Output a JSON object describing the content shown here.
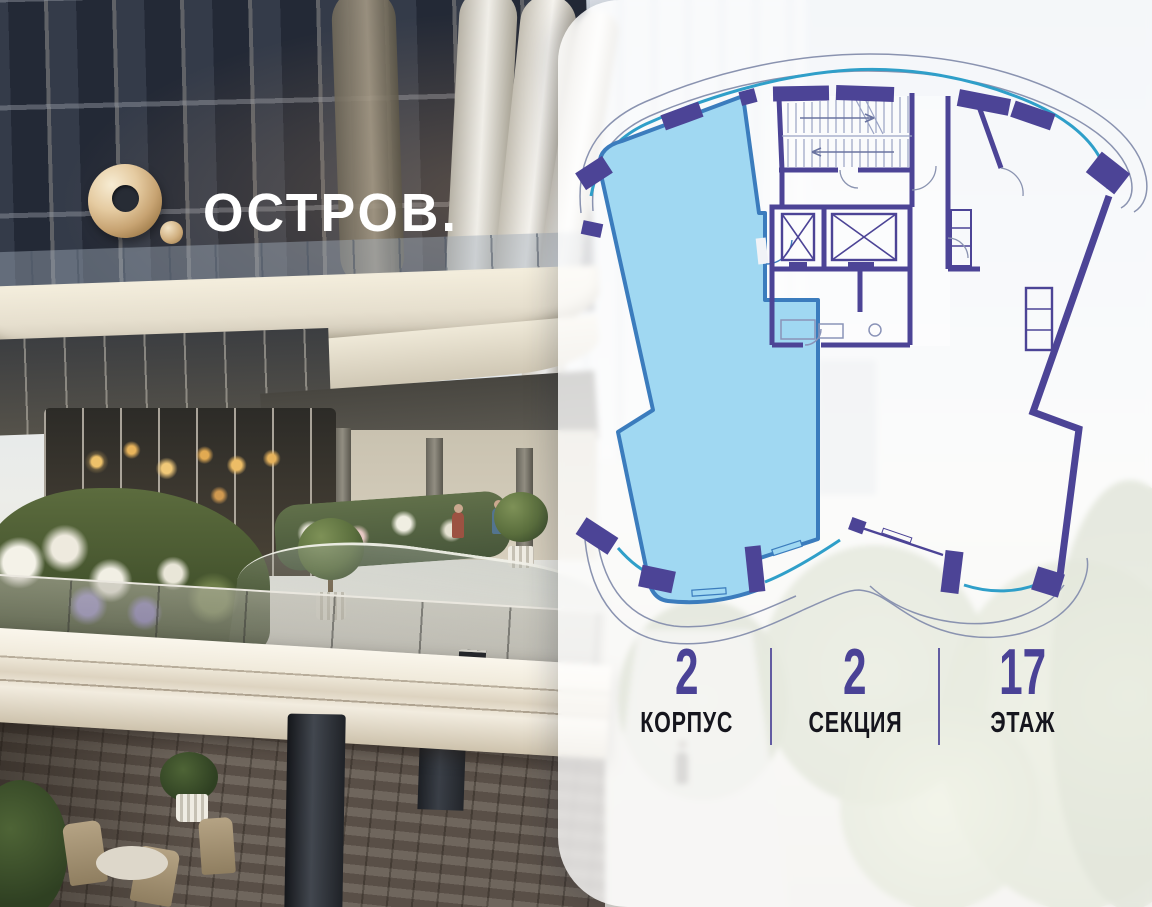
{
  "brand": {
    "logo_text": "ОСТРОВ."
  },
  "panel": {
    "stats": [
      {
        "value": "2",
        "label": "КОРПУС"
      },
      {
        "value": "2",
        "label": "СЕКЦИЯ"
      },
      {
        "value": "17",
        "label": "ЭТАЖ"
      }
    ],
    "accent_color": "#4a4296",
    "background": "rgba(255,255,255,0.78)"
  },
  "floorplan": {
    "highlighted_unit": {
      "fill": "#a0d8f2",
      "outline": "#3b7cbd",
      "state": "highlighted"
    },
    "wall_color": "#4c4496",
    "glazing_color": "#2f9fc9",
    "outline_color": "#8a93b0",
    "features": [
      "staircase",
      "elevator-shaft-1",
      "elevator-shaft-2",
      "bathroom-core",
      "neighbor-unit",
      "balcony-glazing",
      "facade-columns"
    ]
  },
  "colors": {
    "logo_gold": "#cfae7e",
    "photo_dominant": "#3a4251"
  }
}
